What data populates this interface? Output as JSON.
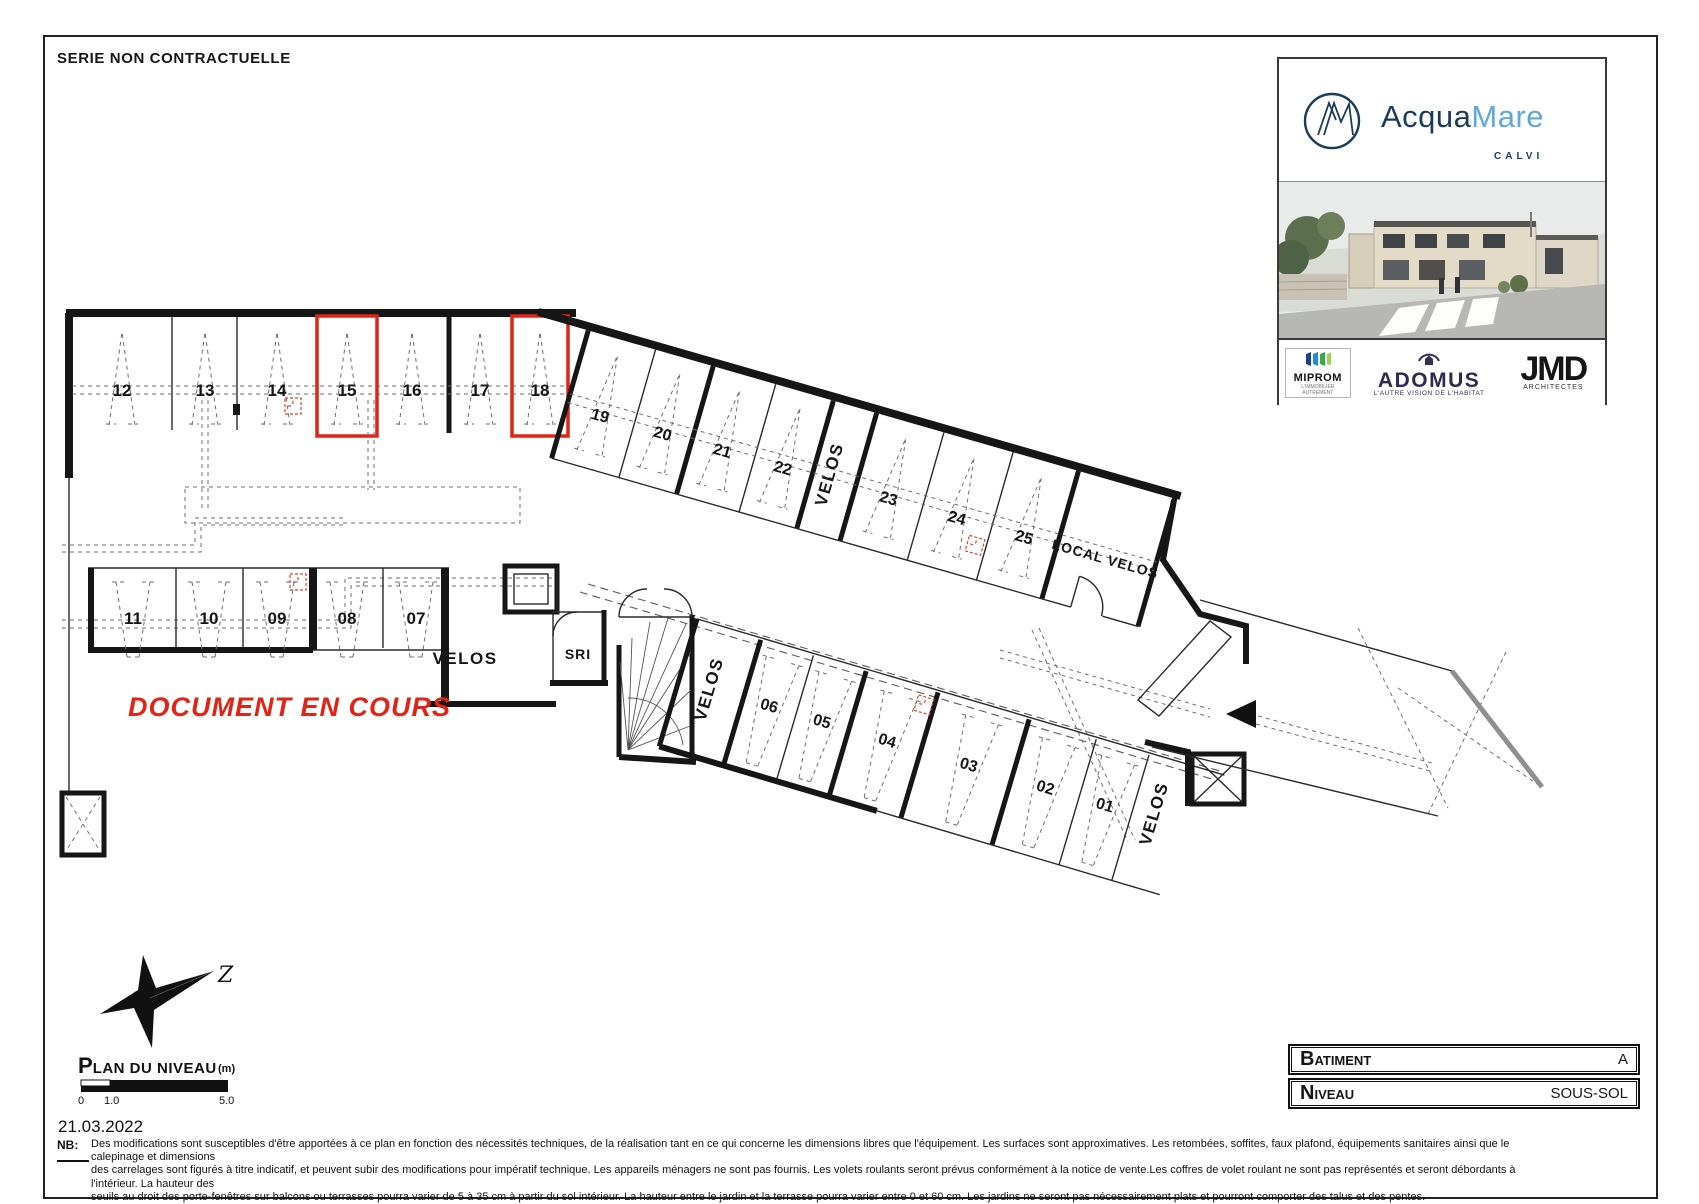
{
  "sheet": {
    "series_note": "SERIE NON CONTRACTUELLE"
  },
  "branding": {
    "name_part1": "Acqua",
    "name_part2": "Mare",
    "city": "CALVI",
    "partners": {
      "miprom": {
        "name": "MIPROM",
        "tagline1": "L'IMMOBILIER",
        "tagline2": "AUTREMENT"
      },
      "adomus": {
        "name": "ADOMUS",
        "tagline": "L'AUTRE VISION DE L'HABITAT"
      },
      "jmd": {
        "name": "JMD",
        "tagline": "ARCHITECTES"
      }
    }
  },
  "plan": {
    "watermark": "DOCUMENT EN COURS",
    "north_label": "Z",
    "stalls_top": [
      "12",
      "13",
      "14",
      "15",
      "16",
      "17",
      "18"
    ],
    "stalls_upper_band": [
      "19",
      "20",
      "21",
      "22",
      "23",
      "24",
      "25"
    ],
    "stalls_left": [
      "11",
      "10",
      "09",
      "08",
      "07"
    ],
    "stalls_lower_band": [
      "06",
      "05",
      "04",
      "03",
      "02",
      "01"
    ],
    "rooms": {
      "velos_upper": "VELOS",
      "local_velos": "LOCAL VELOS",
      "velos_left": "VELOS",
      "sri": "SRI",
      "velos_lower": "VELOS",
      "velos_lower_right": "VELOS"
    }
  },
  "title_block": {
    "title_initial": "P",
    "title_rest": "LAN DU NIVEAU",
    "unit": "(m)",
    "tick0": "0",
    "tick1": "1.0",
    "tick5": "5.0",
    "date": "21.03.2022"
  },
  "info_table": {
    "row1_label_initial": "B",
    "row1_label_rest": "ATIMENT",
    "row1_value": "A",
    "row2_label_initial": "N",
    "row2_label_rest": "IVEAU",
    "row2_value": "SOUS-SOL"
  },
  "footnote": {
    "label": "NB:",
    "line1": "Des modifications sont susceptibles d'être apportées à ce plan en fonction des nécessités techniques, de la réalisation tant en ce qui concerne les dimensions libres que l'équipement. Les surfaces sont approximatives. Les retombées, soffites, faux plafond, équipements sanitaires ainsi que le calepinage et dimensions",
    "line2": "des carrelages sont figurés à titre indicatif, et peuvent subir des modifications pour impératif technique. Les appareils ménagers ne sont pas fournis. Les volets roulants seront prévus conformément à la notice de vente.Les coffres de volet roulant ne sont pas représentés et seront débordants à l'intérieur. La hauteur des",
    "line3": "seuils au droit des porte-fenêtres sur balcons ou terrasses pourra varier de 5 à 35 cm à partir du sol intérieur. La hauteur entre le jardin et la terrasse pourra varier entre 0 et 60 cm. Les jardins ne seront pas nécessairement plats et pourront comporter des talus et des pentes."
  },
  "colors": {
    "accent_red": "#e02417",
    "navy": "#1c3a59",
    "light_blue": "#5da9dc"
  }
}
